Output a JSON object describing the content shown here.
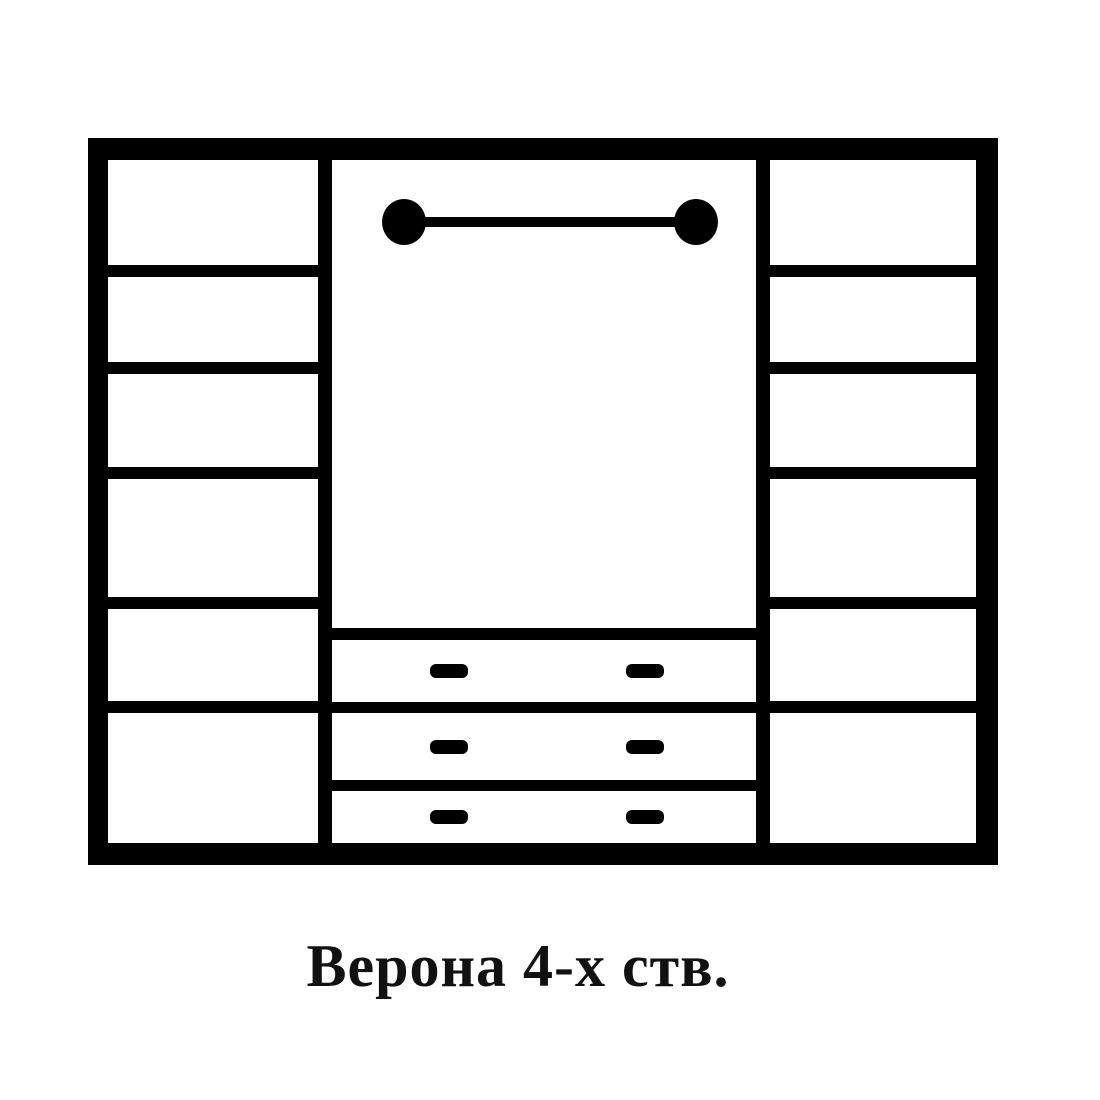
{
  "caption": {
    "text": "Верона 4-х ств."
  },
  "colors": {
    "line": "#000000",
    "background": "#ffffff",
    "caption_text": "#111111"
  },
  "diagram": {
    "kind": "wardrobe-front-schematic",
    "left_column": {
      "compartment_count": 6
    },
    "right_column": {
      "compartment_count": 6
    },
    "center_section": {
      "hanging_rod": "rod-with-ball-end-caps",
      "drawer_count": 3,
      "handles_per_drawer": 2
    }
  }
}
